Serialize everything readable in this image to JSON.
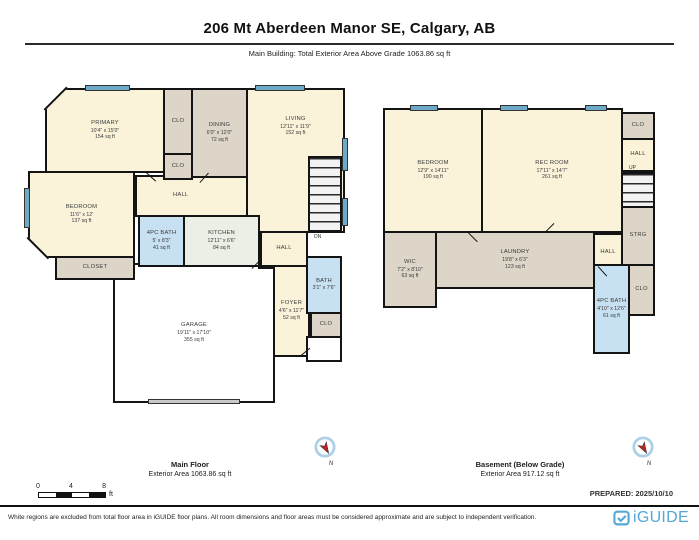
{
  "header": {
    "title": "206 Mt Aberdeen Manor SE, Calgary, AB",
    "subtitle": "Main Building: Total Exterior Area Above Grade 1063.86 sq ft"
  },
  "main_floor": {
    "caption_title": "Main Floor",
    "caption_area": "Exterior Area 1063.86 sq ft",
    "rooms": [
      {
        "name": "PRIMARY",
        "dims": "10'4\" x 15'0\"",
        "area": "154 sq ft"
      },
      {
        "name": "CLO"
      },
      {
        "name": "CLO"
      },
      {
        "name": "DINING",
        "dims": "6'0\" x 12'0\"",
        "area": "72 sq ft"
      },
      {
        "name": "LIVING",
        "dims": "12'11\" x 11'9\"",
        "area": "152 sq ft"
      },
      {
        "name": "HALL"
      },
      {
        "name": "BEDROOM",
        "dims": "11'6\" x 12'",
        "area": "137 sq ft"
      },
      {
        "name": "4PC BATH",
        "dims": "5' x 8'3\"",
        "area": "41 sq ft"
      },
      {
        "name": "KITCHEN",
        "dims": "12'11\" x 6'6\"",
        "area": "84 sq ft"
      },
      {
        "name": "PANTRY"
      },
      {
        "name": "CLOSET"
      },
      {
        "name": "DN"
      },
      {
        "name": "HALL"
      },
      {
        "name": "FOYER",
        "dims": "4'6\" x 11'7\"",
        "area": "52 sq ft"
      },
      {
        "name": "BATH",
        "dims": "3'1\" x 7'6\""
      },
      {
        "name": "CLO"
      },
      {
        "name": "GARAGE",
        "dims": "19'11\" x 17'10\"",
        "area": "355 sq ft"
      }
    ]
  },
  "basement": {
    "caption_title": "Basement (Below Grade)",
    "caption_area": "Exterior Area 917.12 sq ft",
    "rooms": [
      {
        "name": "BEDROOM",
        "dims": "12'9\" x 14'11\"",
        "area": "190 sq ft"
      },
      {
        "name": "REC ROOM",
        "dims": "17'11\" x 14'7\"",
        "area": "261 sq ft"
      },
      {
        "name": "CLO"
      },
      {
        "name": "HALL"
      },
      {
        "name": "UP"
      },
      {
        "name": "STRG"
      },
      {
        "name": "HALL"
      },
      {
        "name": "CLO"
      },
      {
        "name": "WIC",
        "dims": "7'2\" x 8'10\"",
        "area": "63 sq ft"
      },
      {
        "name": "LAUNDRY",
        "dims": "19'8\" x 6'3\"",
        "area": "123 sq ft"
      },
      {
        "name": "4PC BATH",
        "dims": "4'10\" x 12'6\"",
        "area": "61 sq ft"
      }
    ]
  },
  "compass": {
    "label": "N"
  },
  "scale_bar": {
    "ticks": [
      "0",
      "4",
      "8"
    ],
    "unit": "ft"
  },
  "prepared_label": "PREPARED: 2025/10/10",
  "footer": {
    "disclaimer": "White regions are excluded from total floor area in iGUIDE floor plans. All room dimensions and floor areas must be considered approximate and are subject to independent verification.",
    "brand": "iGUIDE"
  },
  "colors": {
    "wall": "#141414",
    "room_cream": "#faf3da",
    "room_tan": "#ddd6c8",
    "room_blue": "#c7e0f2",
    "room_green": "#eaf0e6",
    "window": "#6ea9c8",
    "brand_blue": "#55a8d5",
    "compass_red": "#c02020"
  }
}
